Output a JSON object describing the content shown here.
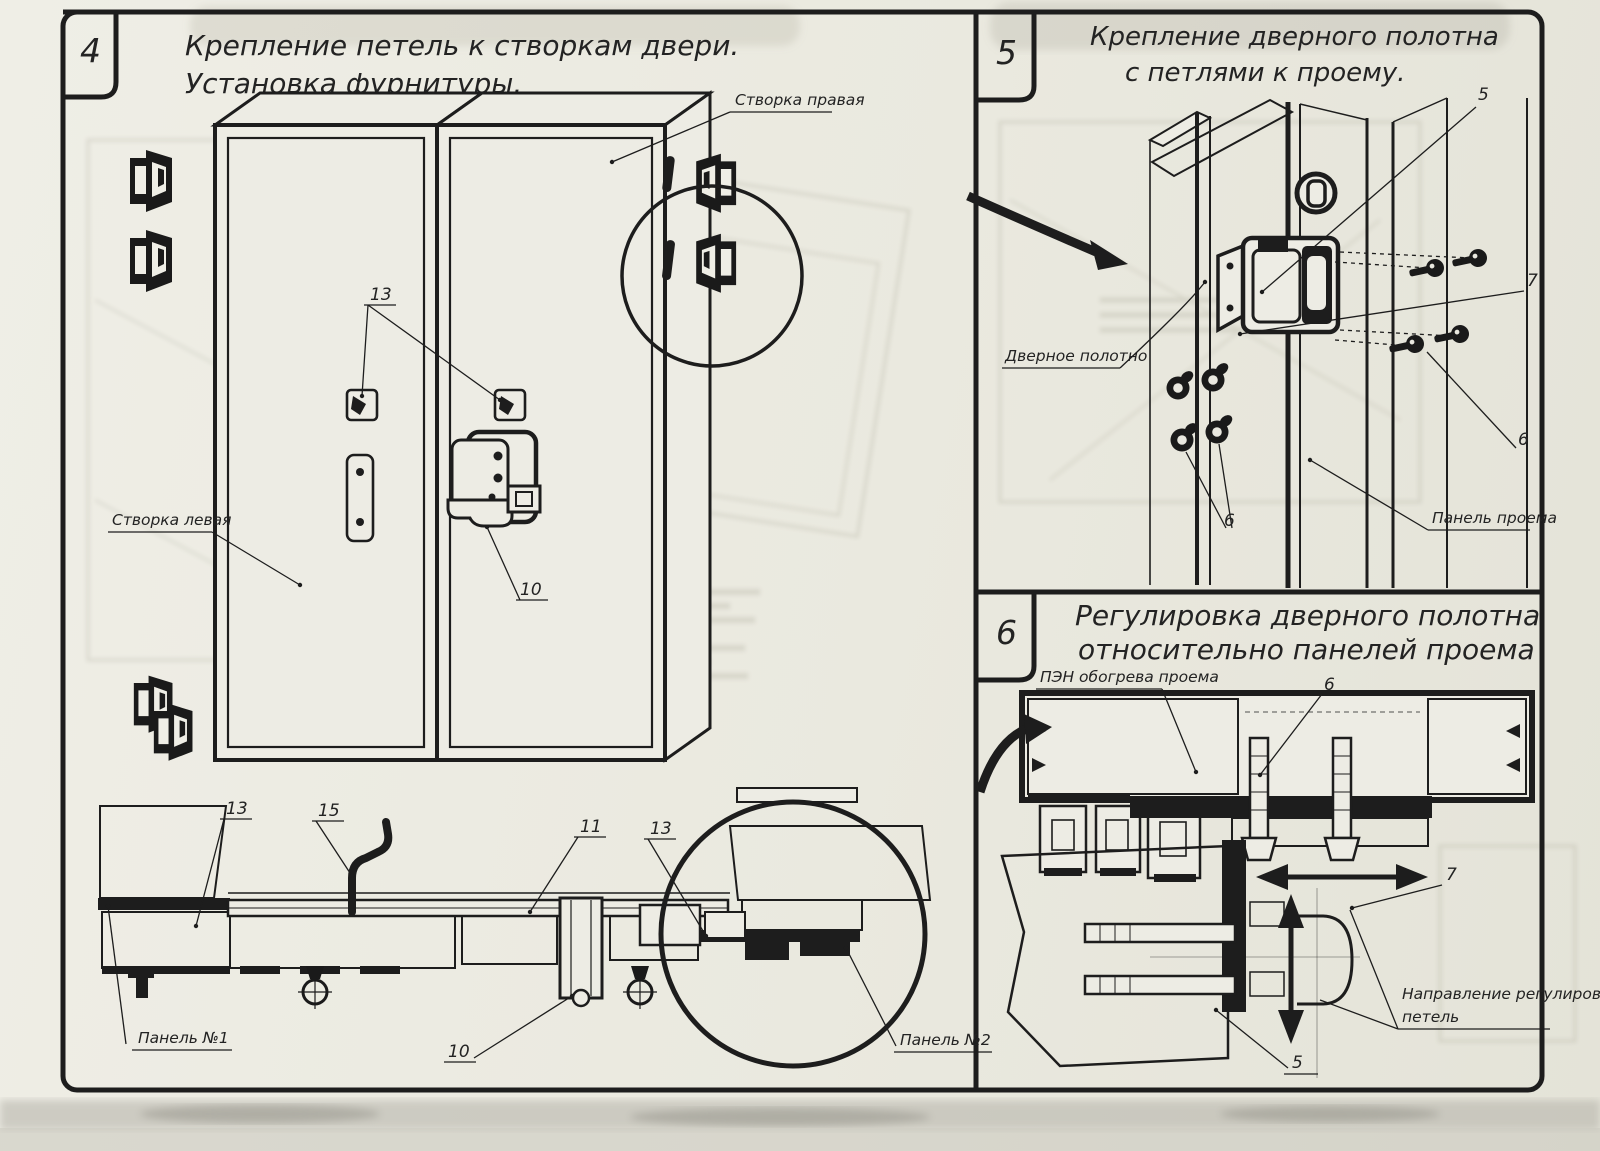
{
  "sheet": {
    "bg": "#ecebe2",
    "ink": "#1d1d1d"
  },
  "panel4": {
    "step": "4",
    "title1": "Крепление петель к створкам двери.",
    "title2": "Установка фурнитуры.",
    "label_right_leaf": "Створка правая",
    "label_left_leaf": "Створка левая",
    "label_panel1": "Панель №1",
    "label_panel2": "Панель №2",
    "callout_13_top": "13",
    "callout_10_latch": "10",
    "callout_13_left": "13",
    "callout_15": "15",
    "callout_11": "11",
    "callout_13_right": "13",
    "callout_10_bottom": "10"
  },
  "panel5": {
    "step": "5",
    "title1": "Крепление дверного полотна",
    "title2": "с петлями к проему.",
    "label_door_leaf": "Дверное полотно",
    "label_opening_panel": "Панель проема",
    "callout_5": "5",
    "callout_7": "7",
    "callout_6_right": "6",
    "callout_6_left": "6"
  },
  "panel6": {
    "step": "6",
    "title1": "Регулировка дверного полотна",
    "title2": "относительно панелей проема",
    "label_heater": "ПЭН обогрева проема",
    "label_direction1": "Направление регулировки",
    "label_direction2": "петель",
    "callout_6": "6",
    "callout_7": "7",
    "callout_5": "5"
  }
}
